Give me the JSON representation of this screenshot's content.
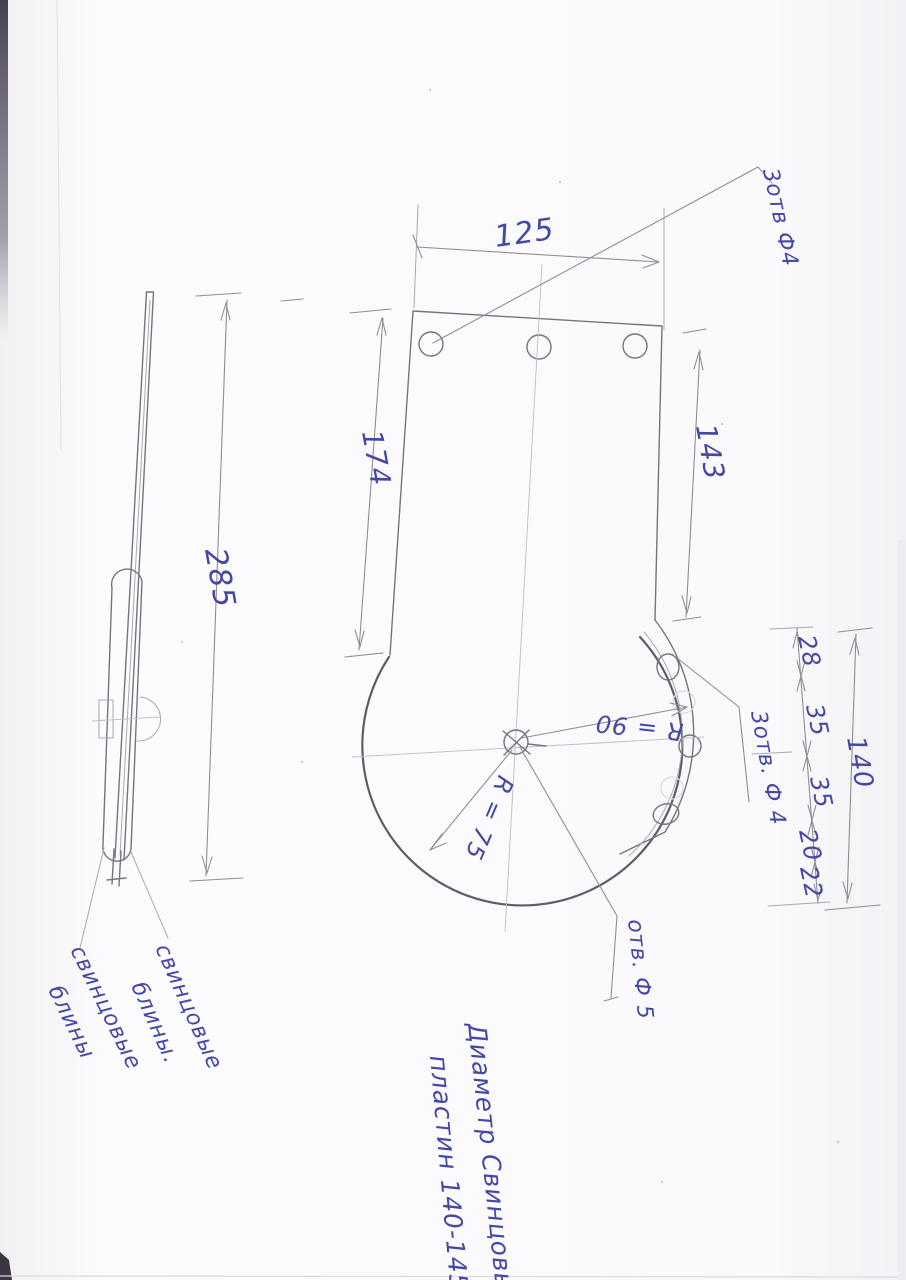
{
  "drawing": {
    "dim_top_width": "125",
    "dim_plate_left": "174",
    "dim_plate_right": "143",
    "dim_overall": "285",
    "dim_seg_1": "28",
    "dim_seg_2": "35",
    "dim_seg_3": "35",
    "dim_seg_4": "20",
    "dim_seg_5": "22",
    "dim_chain_total": "140",
    "radius_large": "R = 90",
    "radius_small": "R = 75",
    "label_holes_top": "3отв Ф4",
    "label_holes_right": "3отв. Ф 4",
    "label_center_hole": "отв. Ф 5",
    "note_line1": "Диаметр Свинцовых",
    "note_line2": "пластин 140-145мм.",
    "callout_left_line1": "свинцовые",
    "callout_left_line2": "блины",
    "callout_right_line1": "свинцовые",
    "callout_right_line2": "блины.",
    "ink_color": "#4547a6",
    "pencil_color": "#75757d"
  }
}
